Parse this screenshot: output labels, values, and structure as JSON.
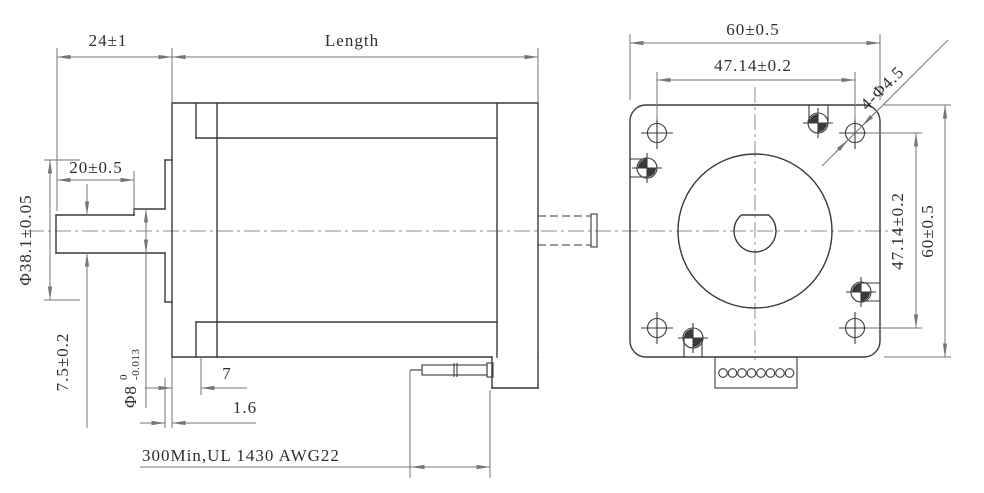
{
  "drawing": {
    "kind": "stepper-motor-outline-dimension-drawing",
    "side_view": {
      "shaft_extension": "24±1",
      "body_length": "Length",
      "flat_length": "20±0.5",
      "pilot_diameter": "Φ38.1±0.05",
      "flat_to_bottom": "7.5±0.2",
      "shaft_diameter": {
        "nominal": "Φ8",
        "upper_tol": "0",
        "lower_tol": "-0.013"
      },
      "flange_thickness": "7",
      "pilot_height": "1.6",
      "cable_spec": "300Min,UL 1430 AWG22"
    },
    "front_view": {
      "width": "60±0.5",
      "hole_spacing_horizontal": "47.14±0.2",
      "mounting_holes": "4-Φ4.5",
      "hole_spacing_vertical": "47.14±0.2",
      "height": "60±0.5"
    },
    "colors": {
      "background": "#ffffff",
      "object_line": "#3a3a3a",
      "dimension_line": "#767676",
      "centerline": "#8f8f8f",
      "text": "#2e2e2e"
    }
  }
}
